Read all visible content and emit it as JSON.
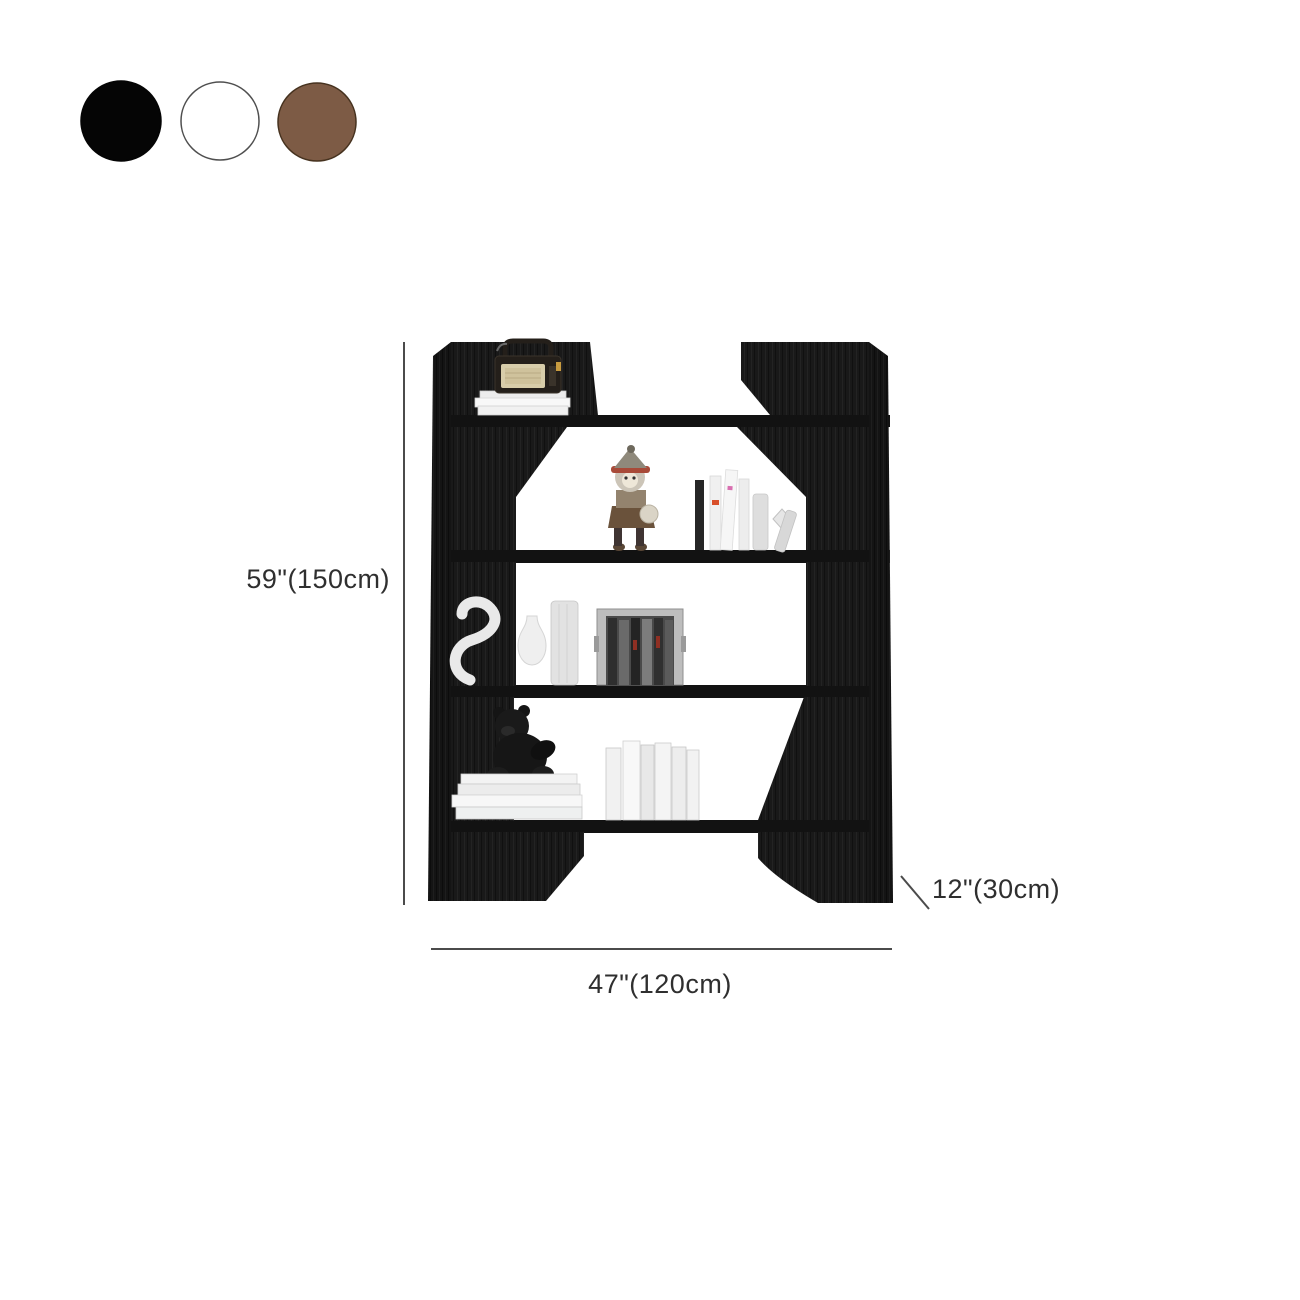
{
  "swatches": {
    "items": [
      {
        "name": "black",
        "color": "#050505",
        "border": "#050505"
      },
      {
        "name": "white",
        "color": "#ffffff",
        "border": "#4f4f4f"
      },
      {
        "name": "brown",
        "color": "#7d5b45",
        "border": "#46321f"
      }
    ]
  },
  "dimensions": {
    "height_label": "59\"(150cm)",
    "width_label": "47\"(120cm)",
    "depth_label": "12\"(30cm)"
  },
  "colors": {
    "annotation_text": "#2f2f2f",
    "dimension_line": "#4b4b4b",
    "shelf_black": "#181818",
    "background": "#ffffff"
  }
}
